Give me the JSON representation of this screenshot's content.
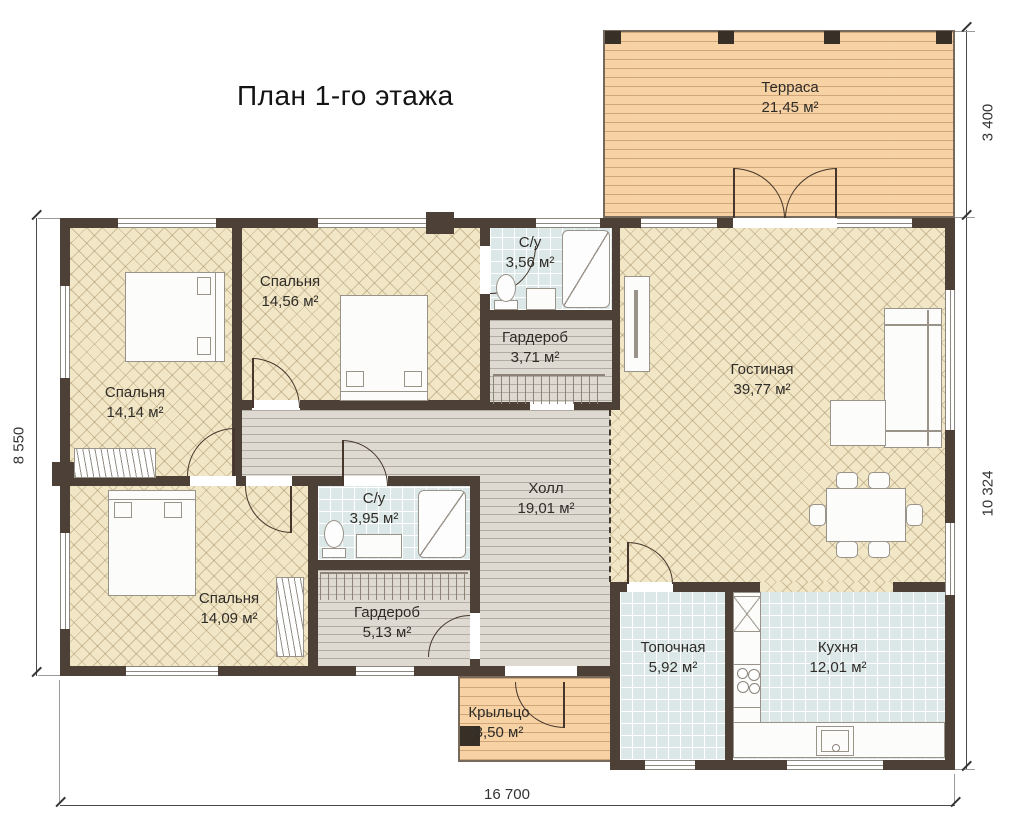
{
  "title": "План 1-го этажа",
  "rooms": {
    "terrace": {
      "name": "Терраса",
      "area": "21,45 м²"
    },
    "bedroom1": {
      "name": "Спальня",
      "area": "14,14 м²"
    },
    "bedroom2": {
      "name": "Спальня",
      "area": "14,56 м²"
    },
    "bath1": {
      "name": "С/у",
      "area": "3,56 м²"
    },
    "wardrobe1": {
      "name": "Гардероб",
      "area": "3,71 м²"
    },
    "living": {
      "name": "Гостиная",
      "area": "39,77 м²"
    },
    "hall": {
      "name": "Холл",
      "area": "19,01 м²"
    },
    "bath2": {
      "name": "С/у",
      "area": "3,95 м²"
    },
    "bedroom3": {
      "name": "Спальня",
      "area": "14,09 м²"
    },
    "wardrobe2": {
      "name": "Гардероб",
      "area": "5,13 м²"
    },
    "boiler": {
      "name": "Топочная",
      "area": "5,92 м²"
    },
    "kitchen": {
      "name": "Кухня",
      "area": "12,01 м²"
    },
    "porch": {
      "name": "Крыльцо",
      "area": "3,50 м²"
    }
  },
  "dimensions": {
    "left": "8 550",
    "bottom": "16 700",
    "right_top": "3 400",
    "right_side": "10 324"
  },
  "colors": {
    "wall": "#4c4037",
    "parquet": "#f1e6c6",
    "deck": "#f6d2a4",
    "tile": "#dbe8e7",
    "hall_floor": "#dedad2"
  }
}
